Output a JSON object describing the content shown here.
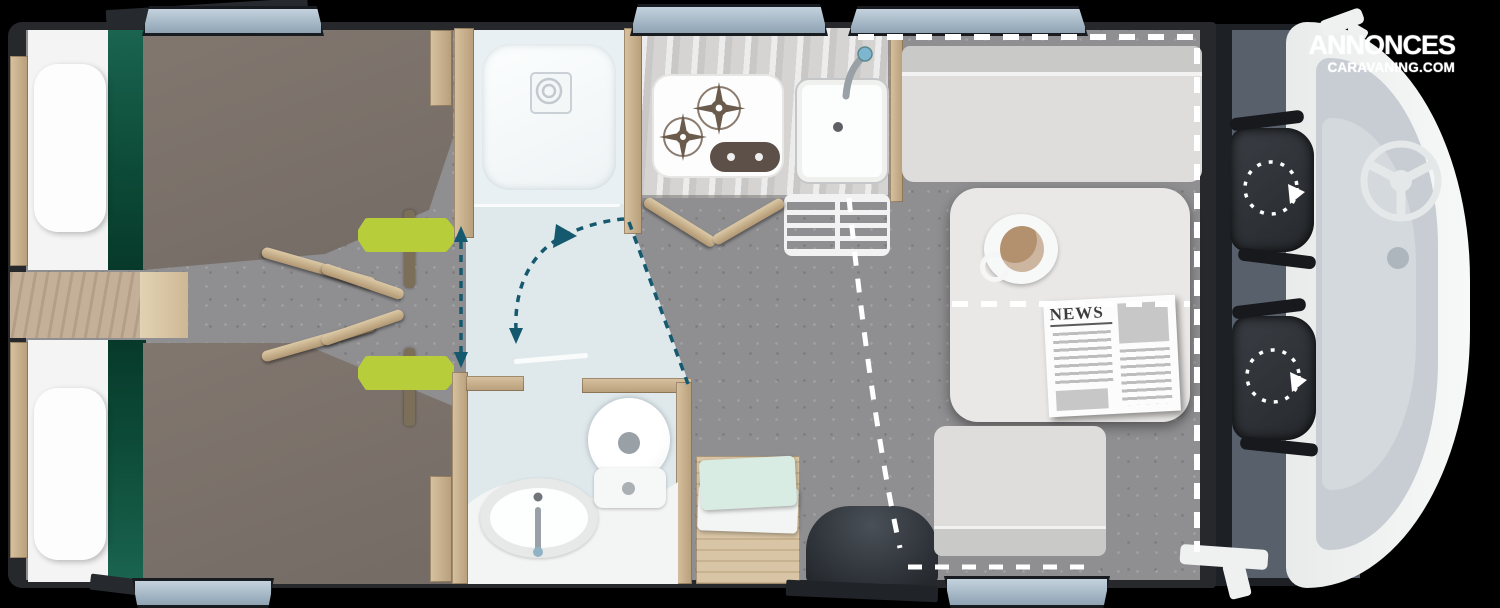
{
  "brand": {
    "line1": "ANNONCES",
    "line2": "CARAVANING.COM"
  },
  "newspaper": {
    "title": "NEWS"
  },
  "diagram": {
    "type": "motorhome-floorplan-top-view",
    "areas": [
      "rear-twin-beds",
      "shower",
      "kitchen",
      "bathroom",
      "dinette",
      "cab"
    ],
    "features": [
      "twin-beds-with-duvets-and-pillows",
      "green-accent-runners",
      "central-wood-steps-and-ladder-rails",
      "lime-grab-handles",
      "sliding-partition-double-arrow",
      "door-swing-arc",
      "shower-tray-with-drain",
      "two-burner-gas-hob",
      "kitchen-sink-with-faucet",
      "heater-grate",
      "washbasin-with-faucet",
      "toilet",
      "dinette-table",
      "coffee-cup",
      "newspaper",
      "bench-seats",
      "drop-down-bed-dashed-outline",
      "entry-door-step-with-open-door",
      "swivel-cab-seats-with-rotation-arrows",
      "steering-wheel",
      "side-mirrors",
      "windows"
    ]
  },
  "colors": {
    "background": "#000000",
    "wall": "#26282c",
    "floor": "#8f8f91",
    "wood": "#c9b28e",
    "duvet": "#7a706a",
    "green_accent": "#0d4c38",
    "bath_floor": "#dfe9ec",
    "counter": "#d7d6d4",
    "hob_burner": "#6b5b4d",
    "bench": "#dedddc",
    "table": "#eae8e6",
    "coffee": "#b3906e",
    "cab_floor": "#57606b",
    "cab_body": "#eef0f1",
    "cab_dash": "#c7cdd3",
    "seat": "#2c3035",
    "teal": "#15596f",
    "lime": "#b7cd3a",
    "window_glass": "#a9bdcc",
    "dash_white": "#ffffff"
  }
}
